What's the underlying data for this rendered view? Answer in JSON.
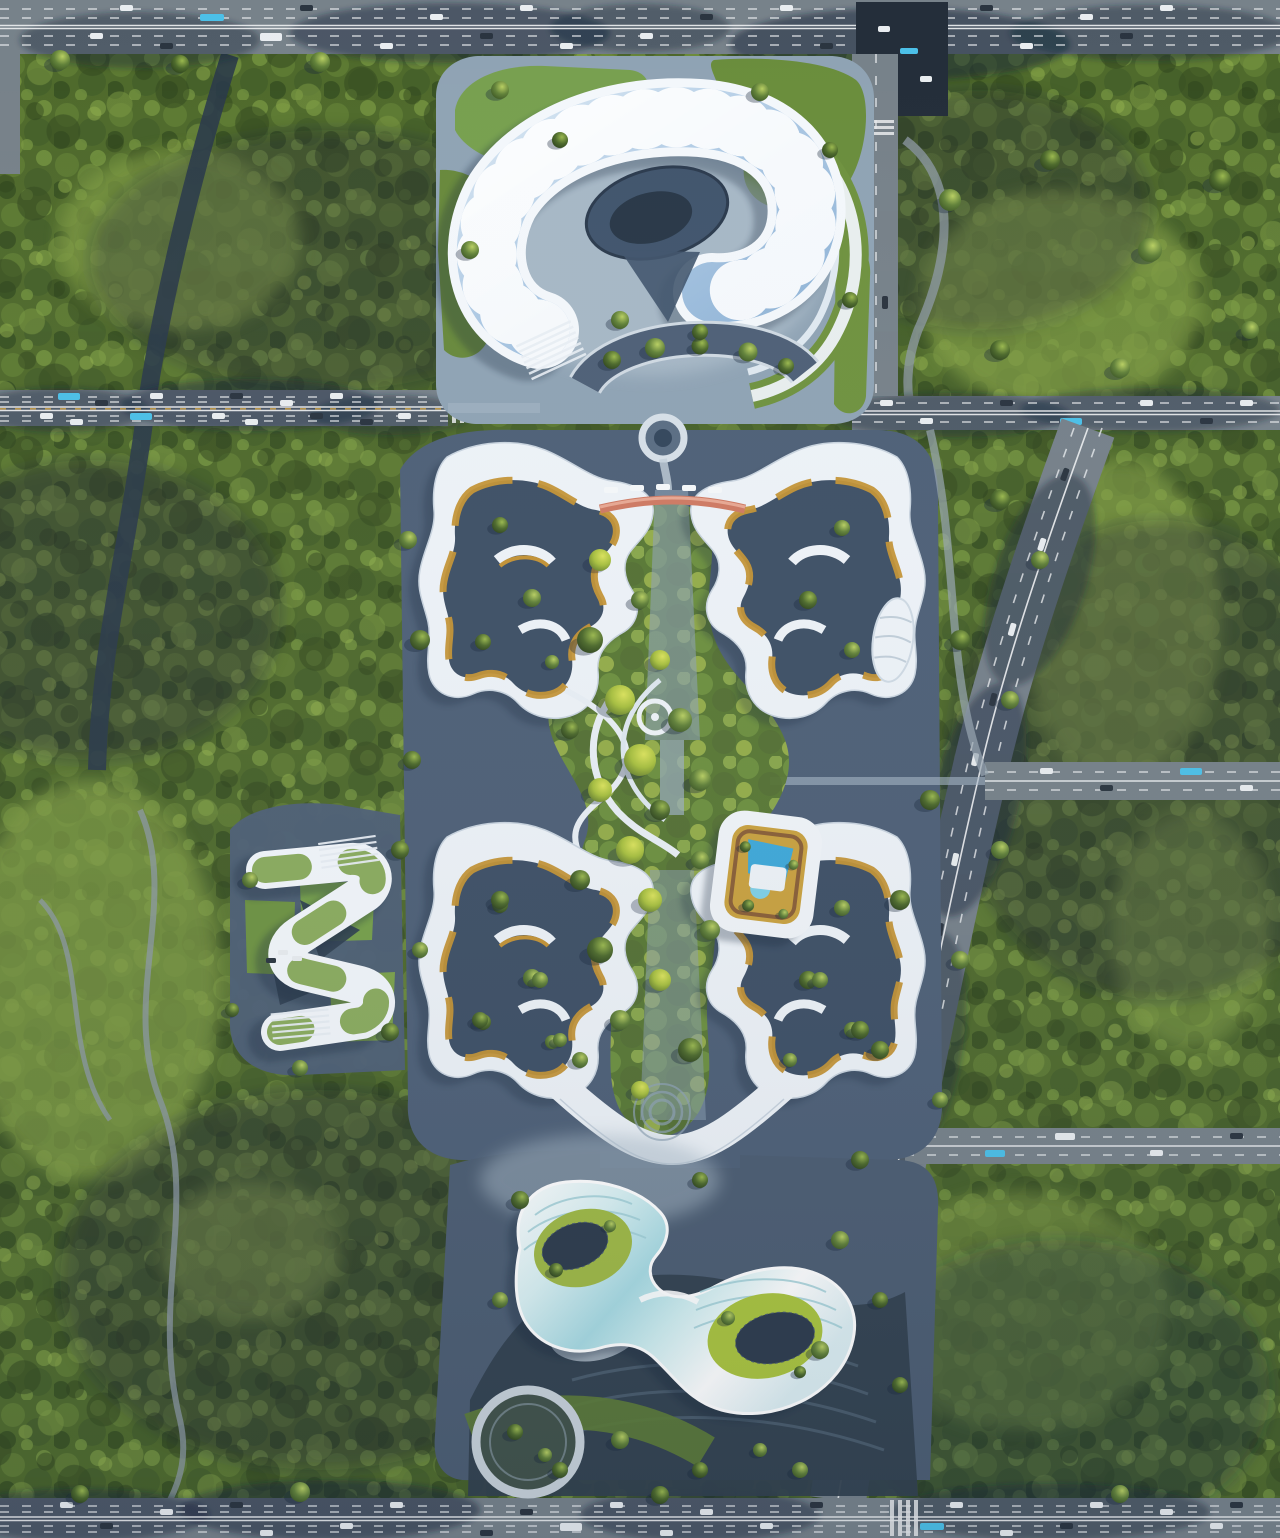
{
  "scene": {
    "kind": "aerial-architectural-masterplan-rendering",
    "view": "top-down bird's-eye render of a green tech-campus surrounded by urban forest blocks and boulevards"
  },
  "landmarks": {
    "crescent_gallery": "crescent gallery building with oval amphitheater court",
    "north_cluster": "north twin courtyard office cluster",
    "sky_bridge": "coral pedestrian sky bridge",
    "central_walkways": "braided central canopy walkways",
    "south_cluster": "south twin courtyard office cluster",
    "roof_garden_court": "rounded roof-garden courtyard building with pools",
    "s_pavilion": "S-shaped terraced pavilion",
    "bowtie_hall": "iridescent bowtie exhibition hall with solar courtyards",
    "amphitheater": "dark terraced amphitheater slope",
    "ring_garden": "circular ring garden",
    "roundabout": "ring fountain roundabout",
    "stream": "forest stream",
    "urban_forest": "urban forest blocks",
    "roads": "perimeter boulevards with traffic"
  },
  "palette": {
    "forest_base": "#4a6128",
    "forest_light": "#7fa04a",
    "forest_dark": "#36491f",
    "lawn": "#76a04a",
    "road_asphalt": "#77828a",
    "road_marking": "#e9ebed",
    "median_orange": "#d8a43a",
    "shadow_blue": "#16253a",
    "plaza_dark": "#4e6077",
    "plaza_light": "#aebfcd",
    "paving_white": "#eef3f8",
    "glass_blue": "#a9c6e2",
    "terrace_ochre": "#c49335",
    "bridge_coral": "#cf7a63",
    "courtyard_navy": "#3e5066",
    "pool_blue": "#3fa9d9",
    "iridescent_cyan": "#aadde4",
    "lawn_bright": "#aac43e",
    "panel_dark": "#2d3b4c",
    "water_dark": "#2b3b4a",
    "car_white": "#e9edf0",
    "car_dark": "#2b3540",
    "bus_cyan": "#4cc0e8"
  }
}
